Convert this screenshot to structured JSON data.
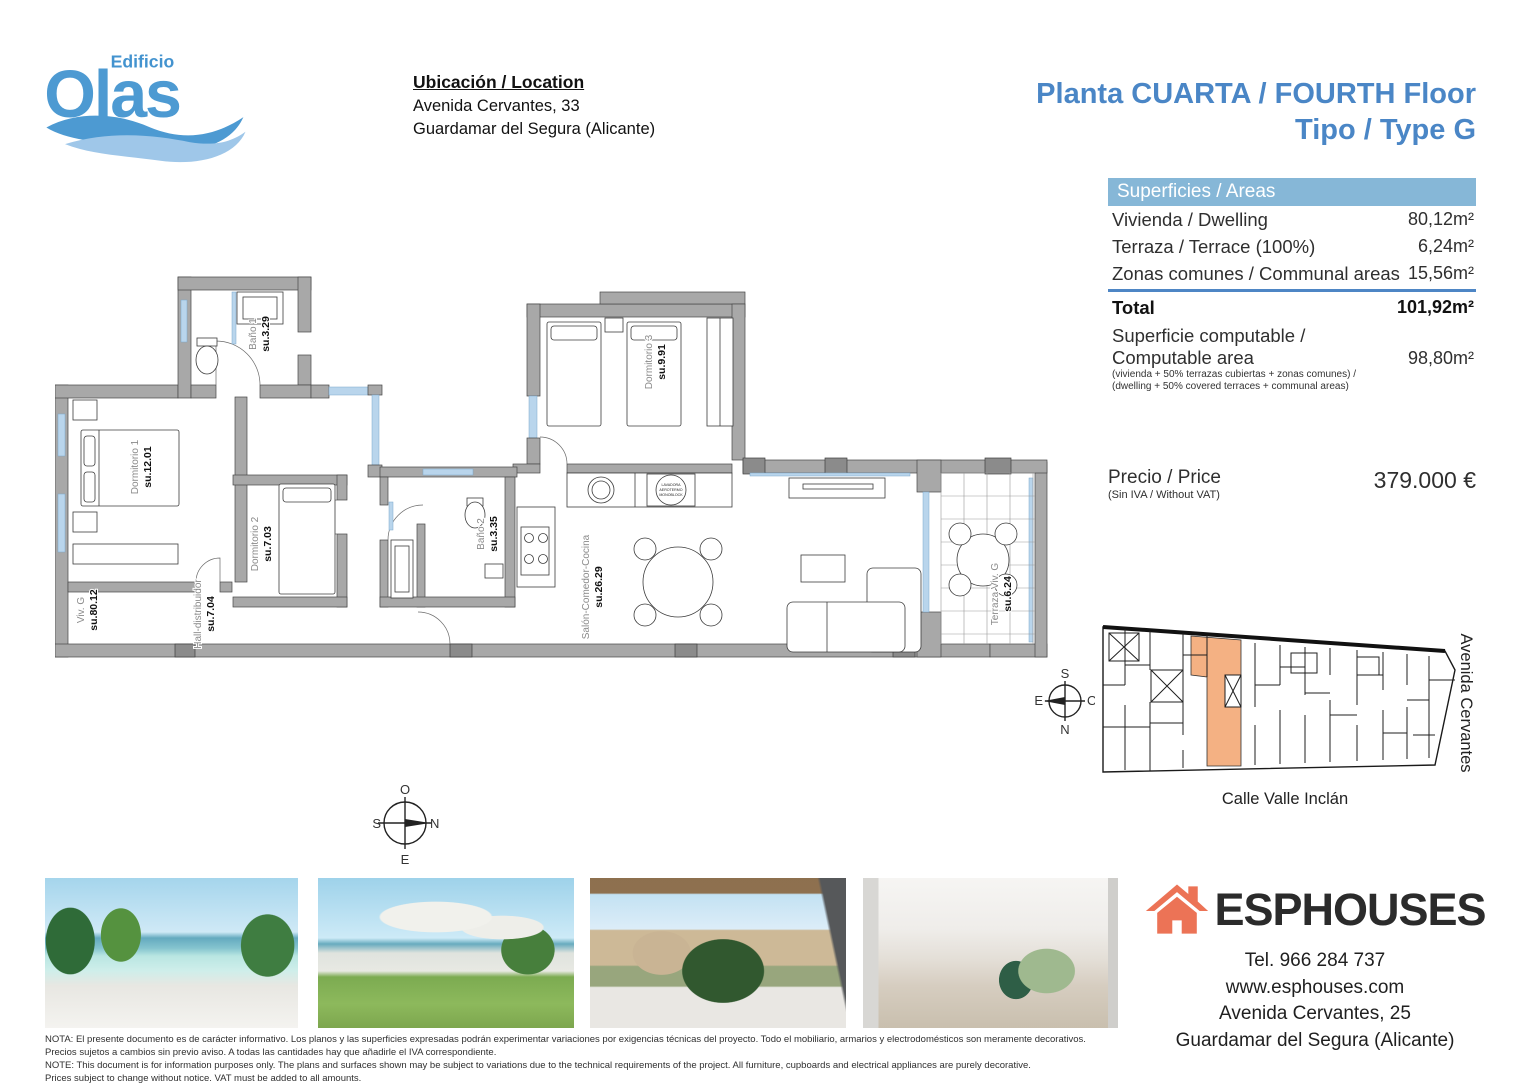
{
  "logo": {
    "edificio": "Edificio",
    "olas": "Olas"
  },
  "location": {
    "title": "Ubicación / Location",
    "address_line1": "Avenida Cervantes, 33",
    "address_line2": "Guardamar del Segura (Alicante)"
  },
  "header": {
    "title_line1": "Planta CUARTA / FOURTH Floor",
    "title_line2": "Tipo / Type G",
    "accent_color": "#4a86c6"
  },
  "areas_table": {
    "header": "Superficies / Areas",
    "rows": [
      {
        "label": "Vivienda / Dwelling",
        "value": "80,12m²"
      },
      {
        "label": "Terraza / Terrace (100%)",
        "value": "6,24m²"
      },
      {
        "label": "Zonas comunes / Communal areas",
        "value": "15,56m²"
      }
    ],
    "total": {
      "label": "Total",
      "value": "101,92m²"
    },
    "computable": {
      "label_line1": "Superficie computable /",
      "label_line2": "Computable area",
      "value": "98,80m²",
      "note_line1": "(vivienda + 50% terrazas cubiertas + zonas comunes) /",
      "note_line2": "(dwelling + 50% covered terraces + communal areas)"
    }
  },
  "price": {
    "label": "Precio / Price",
    "sublabel": "(Sin IVA / Without VAT)",
    "value": "379.000 €"
  },
  "floor_plan": {
    "rooms": [
      {
        "name": "Baño 1",
        "area": "su.3.29"
      },
      {
        "name": "Dormitorio 1",
        "area": "su.12.01"
      },
      {
        "name": "Dormitorio 2",
        "area": "su.7.03"
      },
      {
        "name": "Baño 2",
        "area": "su.3.35"
      },
      {
        "name": "Dormitorio 3",
        "area": "su.9.91"
      },
      {
        "name": "Salón-Comedor-Cocina",
        "area": "su.26.29"
      },
      {
        "name": "Terraza Viv. G",
        "area": "su.6.24"
      },
      {
        "name": "Viv. G",
        "area": "su.80.12"
      },
      {
        "name": "Hall-distribuidor",
        "area": "su.7.04"
      }
    ],
    "equipment": {
      "line1": "LAVADORA",
      "line2": "AEROTERMO",
      "line3": "MONOBLOCK"
    },
    "compass": {
      "top": "O",
      "left": "S",
      "right": "N",
      "bottom": "E"
    }
  },
  "site_plan": {
    "street_bottom": "Calle Valle Inclán",
    "street_right": "Avenida Cervantes",
    "compass": {
      "top": "S",
      "left": "E",
      "right": "O",
      "bottom": "N"
    },
    "highlight_color": "#f4b183"
  },
  "photos": [
    {
      "alt": "Rooftop pool with sea view"
    },
    {
      "alt": "Rooftop terrace with sun loungers"
    },
    {
      "alt": "Balcony view over Avenida Cervantes"
    },
    {
      "alt": "Living room interior"
    }
  ],
  "agency": {
    "name": "ESPHOUSES",
    "phone": "Tel. 966 284 737",
    "website": "www.esphouses.com",
    "address_line1": "Avenida Cervantes, 25",
    "address_line2": "Guardamar del Segura (Alicante)"
  },
  "disclaimer": {
    "lines": [
      "NOTA: El presente documento es de carácter informativo. Los planos y las superficies expresadas podrán experimentar variaciones por exigencias técnicas del proyecto. Todo el mobiliario, armarios y electrodomésticos son meramente decorativos.",
      "Precios sujetos a cambios sin previo aviso. A todas las cantidades hay que añadirle el IVA correspondiente.",
      "NOTE: This document is for information purposes only. The plans and surfaces shown may be subject to variations due to the technical requirements of the project. All furniture, cupboards and electrical appliances are purely decorative.",
      "Prices subject to change without notice. VAT must be added to all amounts."
    ]
  }
}
